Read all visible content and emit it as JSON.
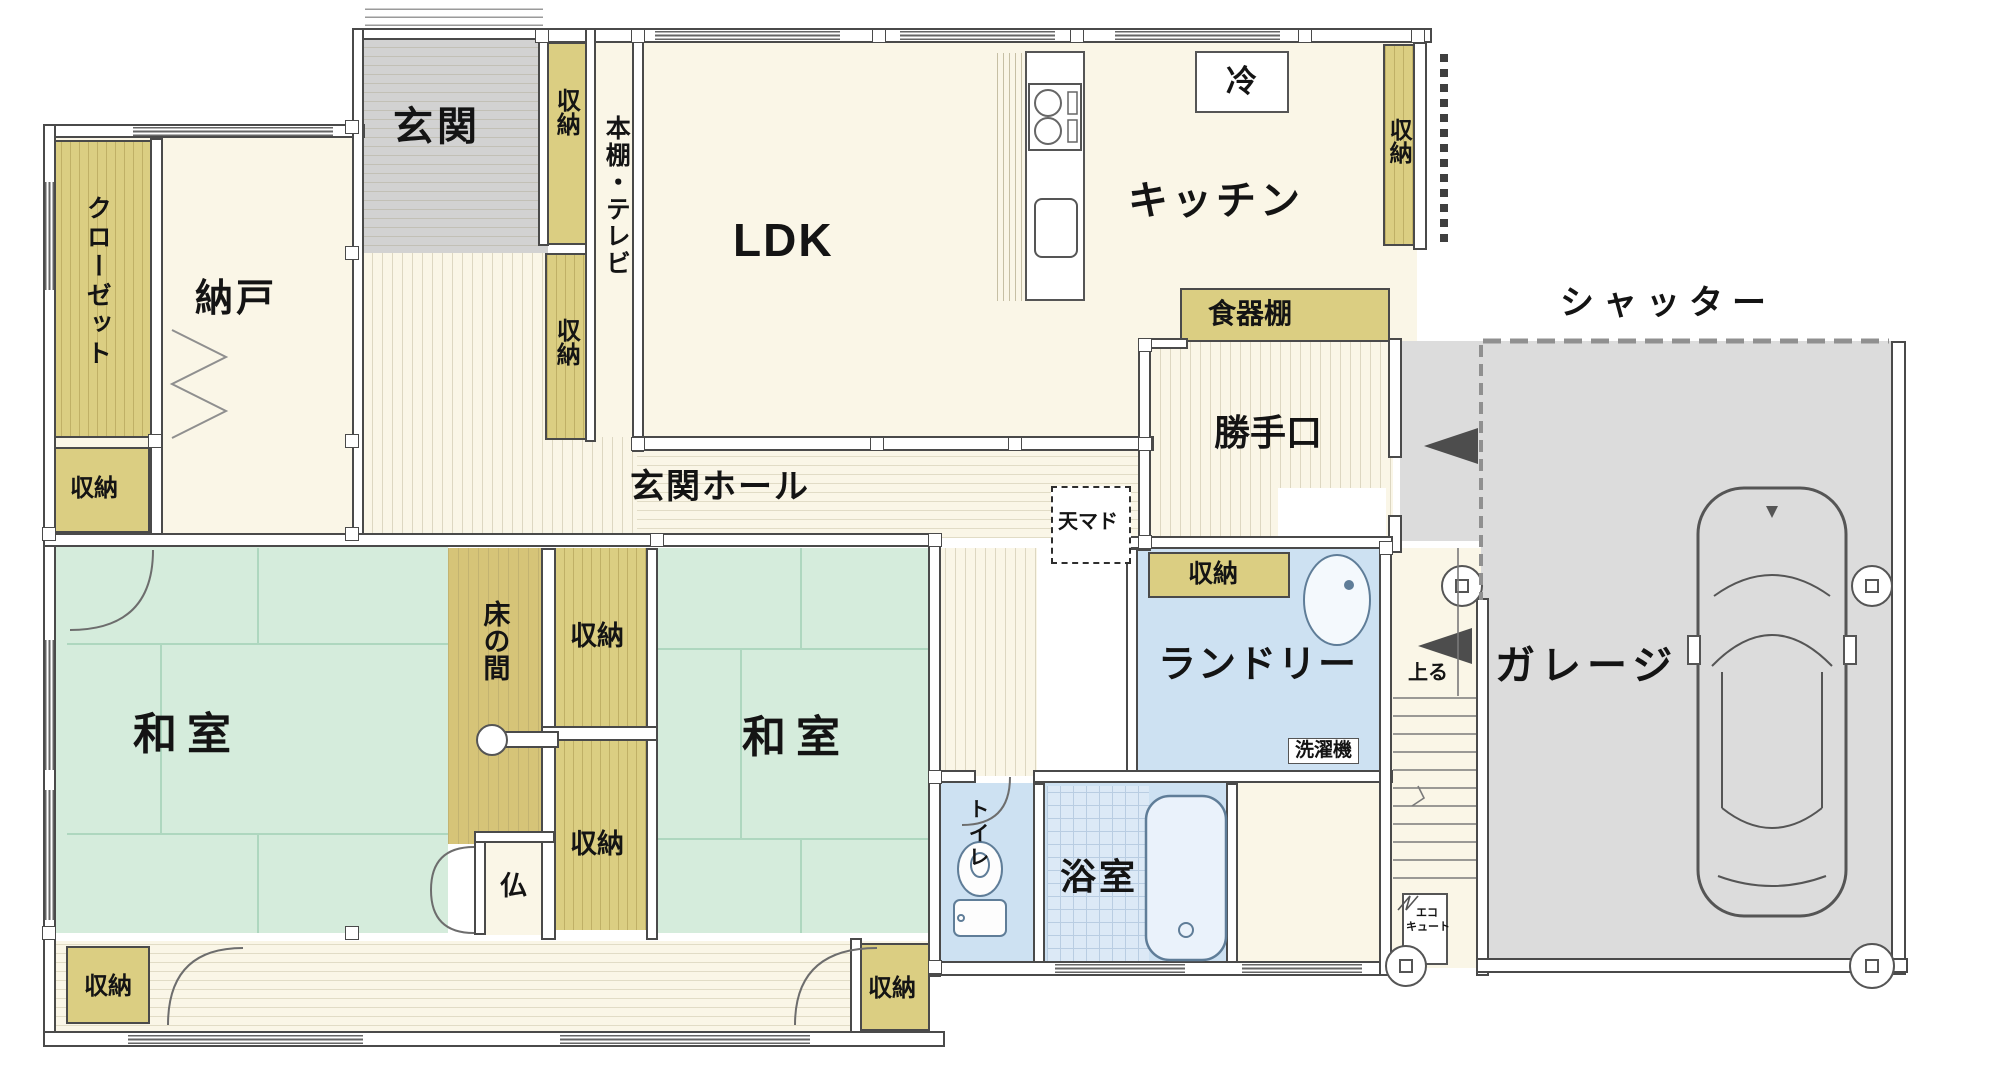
{
  "labels": {
    "genkan": "玄関",
    "storage": "収納",
    "closet": "クローゼット",
    "nando": "納戸",
    "bookshelf_tv": "本棚・テレビ",
    "ldk": "LDK",
    "kitchen": "キッチン",
    "fridge": "冷",
    "dish_cabinet": "食器棚",
    "back_door": "勝手口",
    "shutter": "シャッター",
    "entrance_hall": "玄関ホール",
    "skylight": "天マド",
    "japanese_room": "和室",
    "tokonoma": "床の間",
    "butsudan": "仏",
    "laundry": "ランドリー",
    "washing_machine": "洗濯機",
    "toilet": "トイレ",
    "bath": "浴室",
    "garage": "ガレージ",
    "stairs_up": "上る",
    "ecocute_line1": "エコ",
    "ecocute_line2": "キュート"
  },
  "colors": {
    "tatami": "#d5ecdc",
    "closet_yellow": "#dbce82",
    "tokonoma_wood": "#d6c478",
    "genkan_gray": "#d2d2d2",
    "garage_gray": "#dcdcdc",
    "wet_blue": "#cde1f2",
    "floor_cream": "#faf6e7",
    "wall_line": "#4a4a4a"
  },
  "icons": {
    "car": "car-outline-top-view",
    "toilet": "toilet-bowl-and-tank",
    "sink": "oval-basin",
    "bathtub": "rounded-tub",
    "stove": "two-burner-stove",
    "stairs": "stair-treads",
    "doors": "quarter-circle-door-swings",
    "entry_arrow": "◀"
  }
}
